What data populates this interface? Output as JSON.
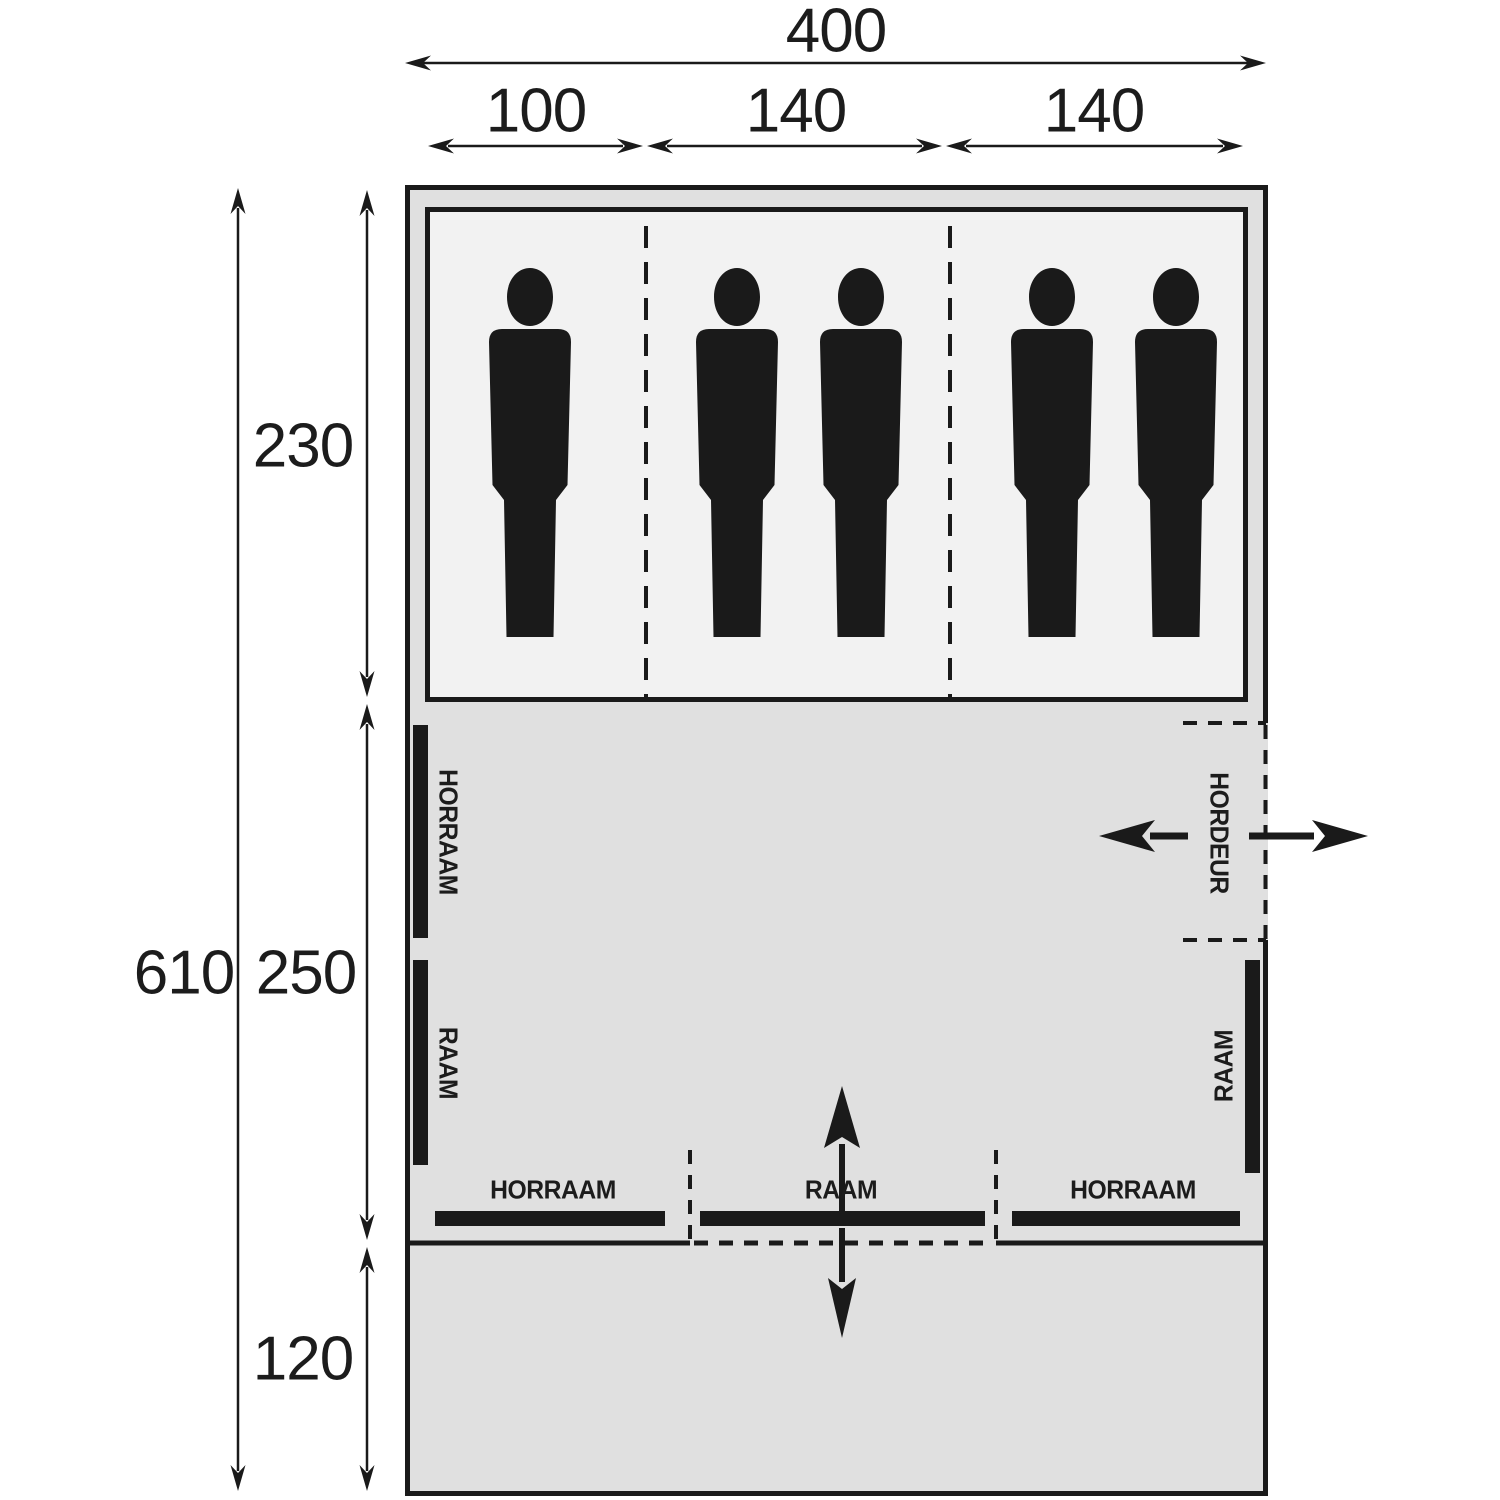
{
  "diagram": {
    "title": "tent-floorplan",
    "colors": {
      "canvas_bg": "#ffffff",
      "tent_fill": "#e0e0e0",
      "cabin_fill": "#f2f2f2",
      "ink": "#1a1a1a"
    },
    "dims": {
      "total_width": "400",
      "cabin_1_width": "100",
      "cabin_2_width": "140",
      "cabin_3_width": "140",
      "cabin_depth": "230",
      "total_depth": "610",
      "living_depth": "250",
      "canopy_depth": "120"
    },
    "windows": {
      "left_top": "HORRAAM",
      "left_bottom": "RAAM",
      "door_right": "HORDEUR",
      "right": "RAAM",
      "bottom_left": "HORRAAM",
      "bottom_center": "RAAM",
      "bottom_right": "HORRAAM"
    },
    "occupants": "5"
  }
}
